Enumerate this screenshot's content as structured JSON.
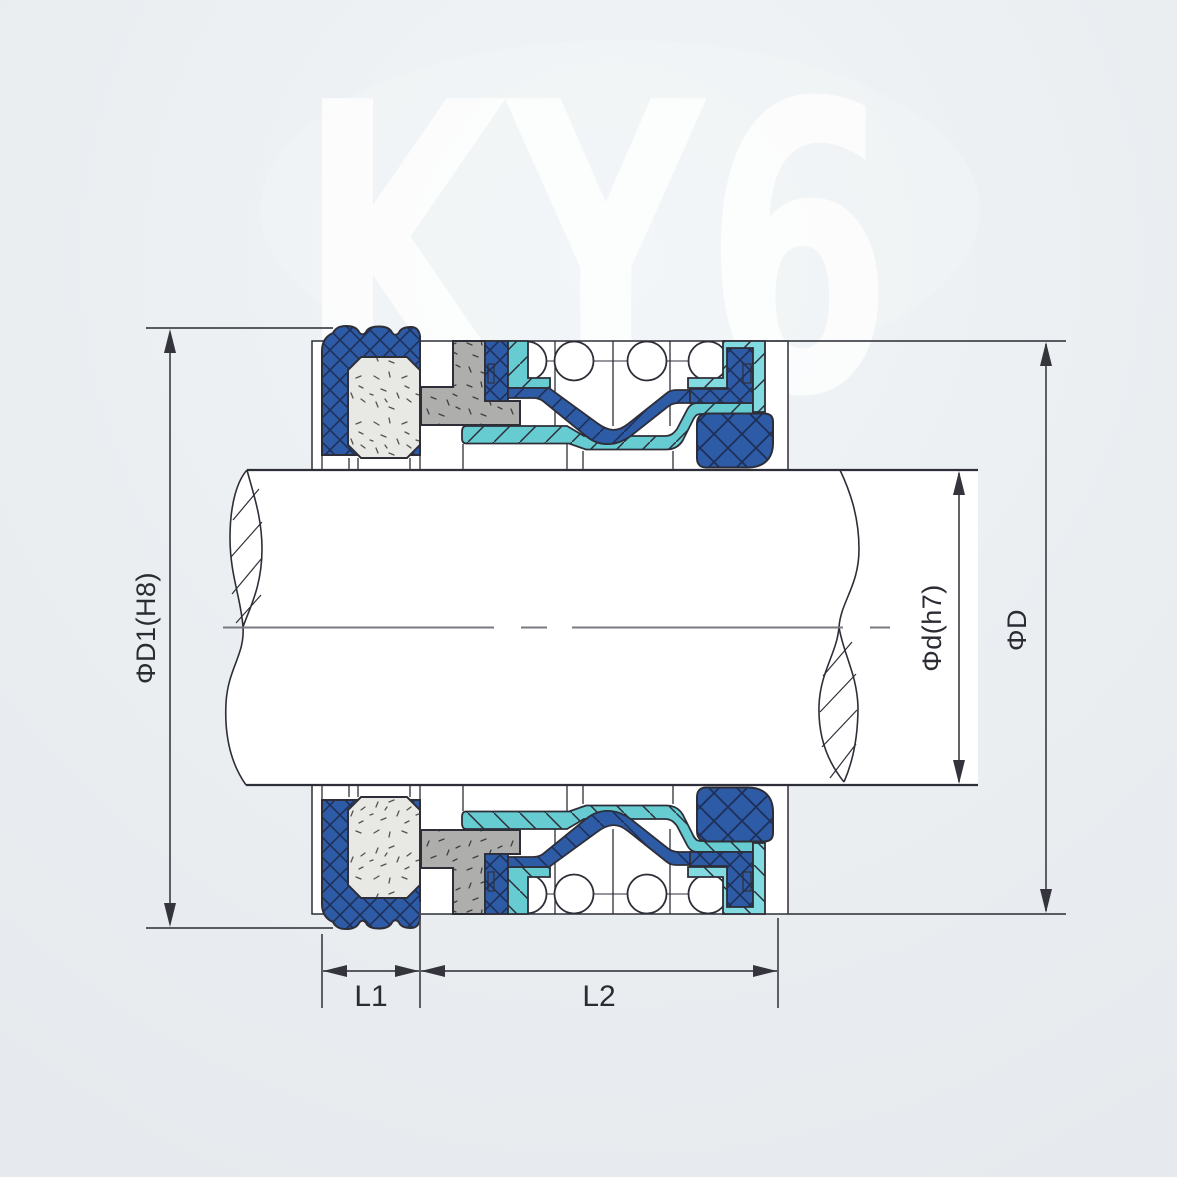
{
  "watermark": {
    "text": "KY6"
  },
  "labels": {
    "dim_d1": "ΦD1(H8)",
    "dim_d": "Φd(h7)",
    "dim_D": "ΦD",
    "dim_l1": "L1",
    "dim_l2": "L2"
  },
  "colors": {
    "background": "#e9edf0",
    "watermark": "#ffffff",
    "outline": "#2e2e38",
    "dark_blue": "#2d5ba6",
    "hatch_navy": "#1e2f58",
    "teal": "#66ccd2",
    "teal_light": "#82dbe0",
    "carbon_gray": "#e8e8e5",
    "steel_gray": "#aeaeac",
    "shaft_fill": "#ffffff",
    "dimension_line": "#46464e",
    "centerline": "#7a7a82",
    "label_text": "#2b2b33"
  }
}
